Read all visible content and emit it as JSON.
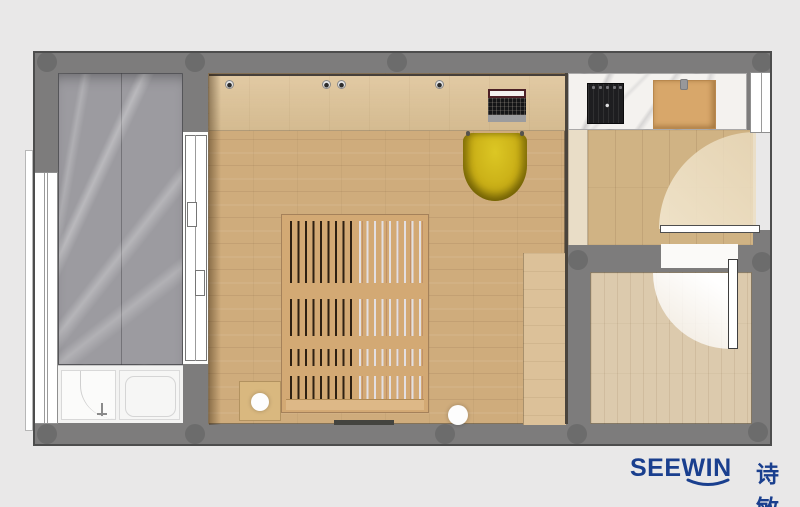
{
  "branding": {
    "logo_latin": "SEEWIN",
    "logo_cjk": "诗敏",
    "logo_color": "#1a3f8e"
  },
  "palette": {
    "background": "#e9e8e8",
    "wall": "#7d7c7c",
    "wall_edge": "#4d4d4d",
    "bathroom_marble": "#9c9ba0",
    "counter_marble": "#f4f2ef",
    "bedroom_floor": "#cfac7c",
    "desk_wood": "#ddc296",
    "hall_floor": "#d0b384",
    "utility_room_floor": "#dccaad",
    "bed_wood": "#d3a974",
    "chair_yellow": "#c9ae16",
    "cooktop_black": "#1e1e20",
    "cutting_board": "#d8a76a",
    "fixture_white": "#f6f6f5"
  },
  "plan_items": [
    "outer-wall",
    "bathroom-marble-room",
    "walk-in-shower-tray",
    "bathtub",
    "left-window",
    "sliding-glass-door",
    "bedroom",
    "desk",
    "laptop",
    "yellow-desk-chair",
    "slatted-platform-bed",
    "bedside-table",
    "table-lamp",
    "floor-lamp",
    "wardrobe",
    "kitchen-marble-counter",
    "induction-cooktop",
    "cutting-board",
    "hallway",
    "entry-door-swing",
    "right-window",
    "utility-room",
    "interior-door-swing"
  ]
}
